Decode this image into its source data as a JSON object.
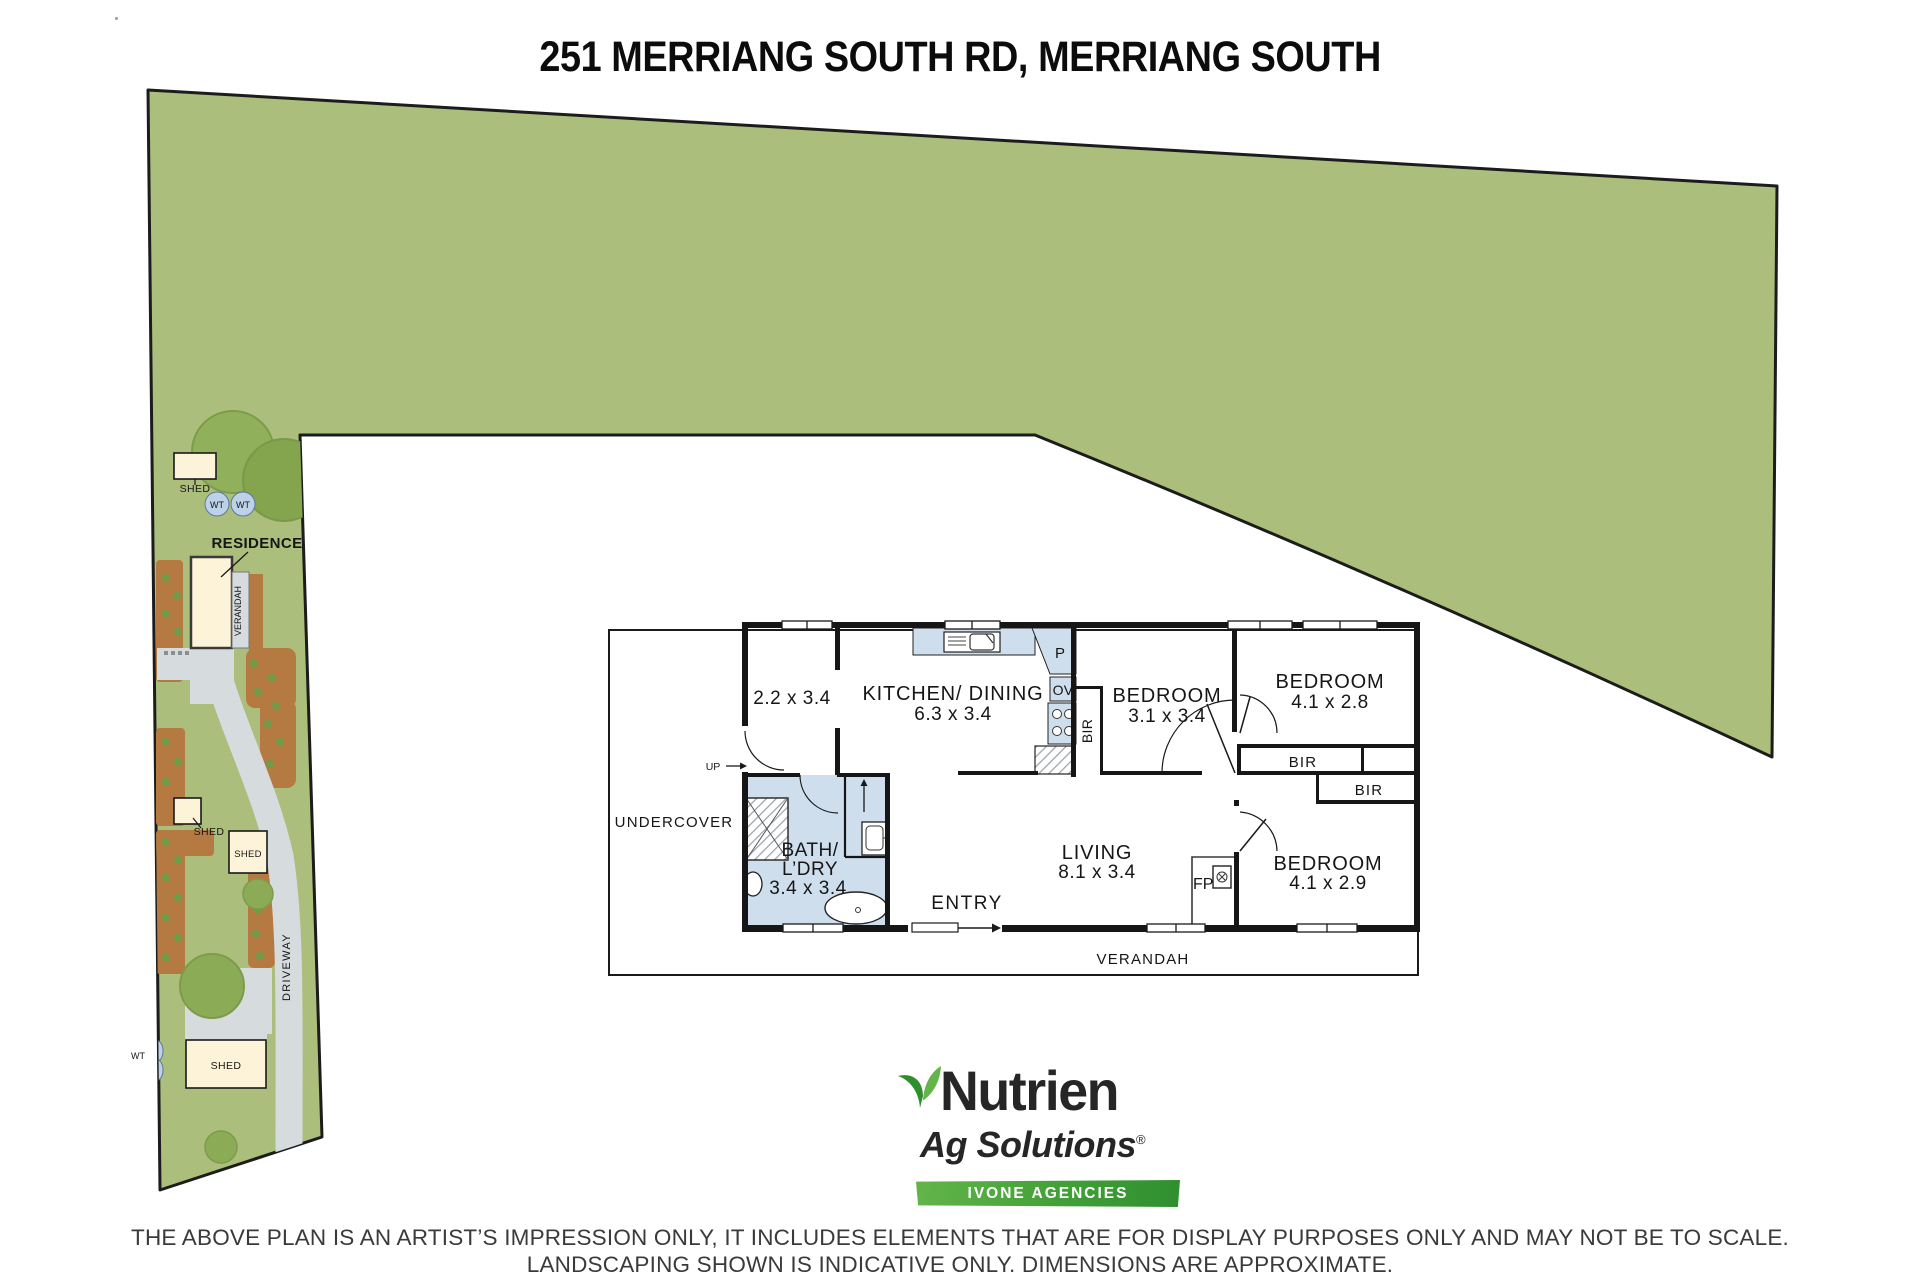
{
  "title": "251 MERRIANG SOUTH RD, MERRIANG SOUTH",
  "site": {
    "residence_label": "RESIDENCE",
    "verandah_label": "VERANDAH",
    "driveway_label": "DRIVEWAY",
    "shed_label": "SHED",
    "water_tank_label": "WT"
  },
  "plan": {
    "undercover_label": "UNDERCOVER",
    "verandah_label": "VERANDAH",
    "entry_label": "ENTRY",
    "up_label": "UP",
    "bir_label": "BIR",
    "fireplace_label": "FP",
    "pantry_label": "P",
    "oven_label": "OV",
    "room_small": {
      "dims": "2.2 x 3.4"
    },
    "kitchen_dining": {
      "name": "KITCHEN/ DINING",
      "dims": "6.3 x 3.4"
    },
    "bedroom_1": {
      "name": "BEDROOM",
      "dims": "3.1 x 3.4"
    },
    "bedroom_2": {
      "name": "BEDROOM",
      "dims": "4.1 x 2.8"
    },
    "bedroom_3": {
      "name": "BEDROOM",
      "dims": "4.1 x 2.9"
    },
    "living": {
      "name": "LIVING",
      "dims": "8.1 x 3.4"
    },
    "bath_laundry": {
      "name_line1": "BATH/",
      "name_line2": "L’DRY",
      "dims": "3.4 x 3.4"
    }
  },
  "footer": {
    "brand": "Nutrien",
    "brand_sub": "Ag Solutions",
    "registered": "®",
    "banner": "IVONE AGENCIES",
    "disclaimer_line1": "THE ABOVE PLAN IS AN ARTIST’S IMPRESSION ONLY, IT INCLUDES ELEMENTS THAT ARE FOR DISPLAY PURPOSES ONLY AND MAY NOT BE TO SCALE.",
    "disclaimer_line2": "LANDSCAPING SHOWN IS INDICATIVE ONLY. DIMENSIONS ARE APPROXIMATE."
  },
  "colors": {
    "land": "#abbe7c",
    "tree": "#8cab57",
    "garden_bed": "#b57a41",
    "path_gray": "#d6dbde",
    "shed_fill": "#fdf3d8",
    "water_tank": "#bdd2e8",
    "wet_area": "#cfdeed",
    "wall": "#161616",
    "banner_green": "#3f9c35"
  }
}
